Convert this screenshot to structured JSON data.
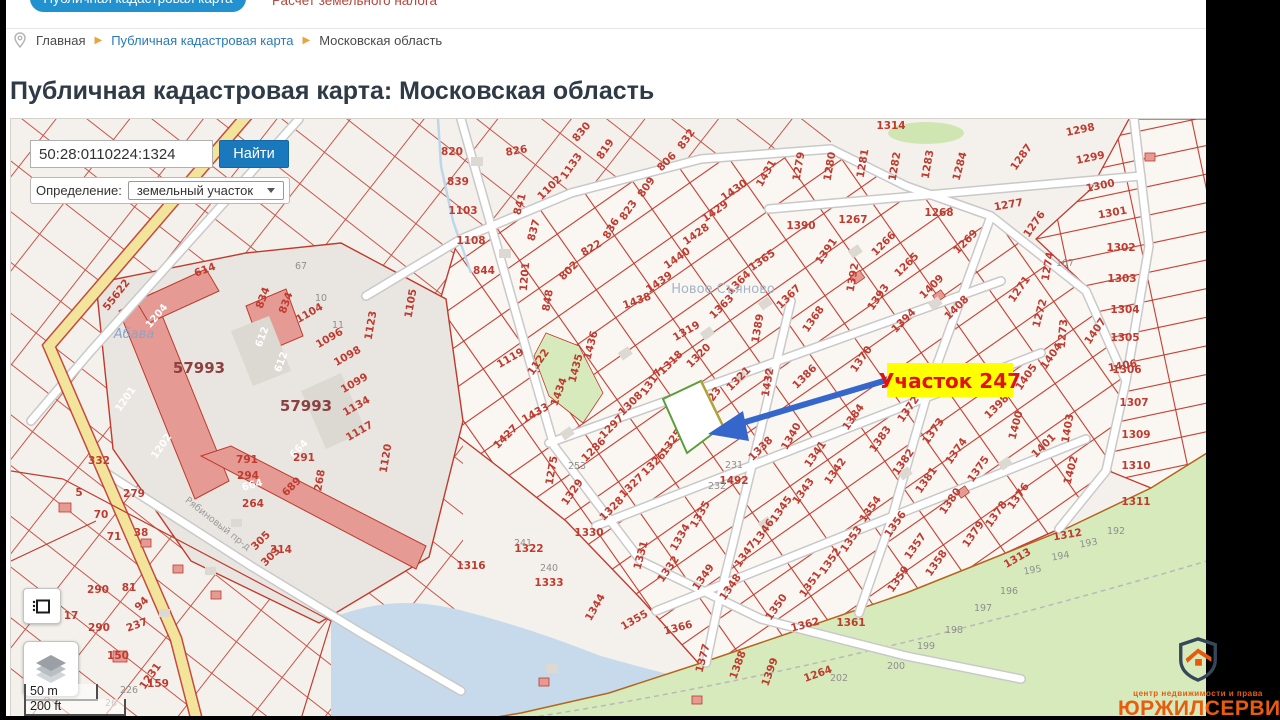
{
  "header": {
    "tab": "Публичная кадастровая карта",
    "link": "Расчет земельного налога"
  },
  "breadcrumb": {
    "items": [
      "Главная",
      "Публичная кадастровая карта",
      "Московская область"
    ]
  },
  "title": "Публичная кадастровая карта: Московская область",
  "search": {
    "value": "50:28:0110224:1324",
    "button": "Найти",
    "filter_label": "Определение:",
    "filter_value": "земельный участок"
  },
  "map": {
    "annotation": {
      "text": "Участок 247",
      "bg": "#ffff00",
      "color": "#e01212"
    },
    "scale": {
      "metric": "50 m",
      "imperial": "200 ft"
    },
    "labels": [
      [
        "55622",
        118,
        296,
        -52
      ],
      [
        "820",
        451,
        154,
        0
      ],
      [
        "839",
        457,
        184,
        0
      ],
      [
        "1103",
        462,
        213,
        0
      ],
      [
        "1108",
        470,
        243,
        0
      ],
      [
        "844",
        483,
        273,
        0
      ],
      [
        "826",
        516,
        153,
        -10
      ],
      [
        "841",
        522,
        204,
        -75
      ],
      [
        "837",
        536,
        230,
        -75
      ],
      [
        "1201",
        527,
        276,
        -85
      ],
      [
        "1133",
        573,
        167,
        -55
      ],
      [
        "1102",
        551,
        189,
        -45
      ],
      [
        "830",
        583,
        133,
        -50
      ],
      [
        "819",
        607,
        150,
        -55
      ],
      [
        "806",
        668,
        163,
        -45
      ],
      [
        "809",
        648,
        188,
        -55
      ],
      [
        "823",
        630,
        211,
        -55
      ],
      [
        "832",
        688,
        140,
        -55
      ],
      [
        "836",
        613,
        229,
        -60
      ],
      [
        "822",
        592,
        250,
        -30
      ],
      [
        "802",
        570,
        272,
        -45
      ],
      [
        "848",
        550,
        300,
        -80
      ],
      [
        "1431",
        768,
        174,
        -60
      ],
      [
        "1430",
        735,
        192,
        -35
      ],
      [
        "1429",
        716,
        213,
        -35
      ],
      [
        "1428",
        697,
        236,
        -35
      ],
      [
        "1440",
        678,
        260,
        -35
      ],
      [
        "1439",
        660,
        284,
        -35
      ],
      [
        "1438",
        637,
        303,
        -20
      ],
      [
        "1279",
        801,
        166,
        -80
      ],
      [
        "1280",
        832,
        166,
        -80
      ],
      [
        "1281",
        865,
        163,
        -80
      ],
      [
        "1282",
        897,
        166,
        -80
      ],
      [
        "1283",
        930,
        164,
        -80
      ],
      [
        "1284",
        962,
        166,
        -75
      ],
      [
        "1314",
        890,
        128,
        0
      ],
      [
        "1267",
        852,
        222,
        0
      ],
      [
        "1390",
        800,
        228,
        0
      ],
      [
        "1268",
        938,
        215,
        0
      ],
      [
        "1269",
        967,
        243,
        -45
      ],
      [
        "1266",
        885,
        245,
        -45
      ],
      [
        "1265",
        908,
        266,
        -45
      ],
      [
        "1409",
        933,
        288,
        -45
      ],
      [
        "1408",
        958,
        309,
        -45
      ],
      [
        "1391",
        828,
        252,
        -55
      ],
      [
        "1392",
        855,
        277,
        -80
      ],
      [
        "1393",
        880,
        298,
        -55
      ],
      [
        "1394",
        905,
        322,
        -45
      ],
      [
        "1365",
        763,
        262,
        -35
      ],
      [
        "1364",
        740,
        284,
        -45
      ],
      [
        "1363",
        723,
        308,
        -45
      ],
      [
        "1367",
        790,
        298,
        -45
      ],
      [
        "1368",
        815,
        320,
        -55
      ],
      [
        "1389",
        760,
        328,
        -80
      ],
      [
        "1319",
        687,
        333,
        -30
      ],
      [
        "1287",
        1023,
        158,
        -55
      ],
      [
        "1298",
        1080,
        132,
        -12
      ],
      [
        "1299",
        1090,
        160,
        -12
      ],
      [
        "1300",
        1100,
        188,
        -12
      ],
      [
        "1301",
        1112,
        215,
        -10
      ],
      [
        "1302",
        1120,
        250,
        0
      ],
      [
        "1303",
        1121,
        281,
        0
      ],
      [
        "1304",
        1124,
        312,
        0
      ],
      [
        "1305",
        1124,
        340,
        0
      ],
      [
        "1306",
        1126,
        372,
        0
      ],
      [
        "1277",
        1008,
        207,
        -10
      ],
      [
        "1276",
        1036,
        225,
        -55
      ],
      [
        "1274",
        1050,
        266,
        -80
      ],
      [
        "1271",
        1021,
        290,
        -55
      ],
      [
        "1272",
        1042,
        313,
        -75
      ],
      [
        "1273",
        1065,
        333,
        -85
      ],
      [
        "167",
        1064,
        265,
        0,
        "g"
      ],
      [
        "1307",
        1133,
        405,
        0
      ],
      [
        "1309",
        1135,
        437,
        0
      ],
      [
        "1310",
        1135,
        468,
        0
      ],
      [
        "1311",
        1135,
        504,
        0
      ],
      [
        "1312",
        1067,
        537,
        -10
      ],
      [
        "1313",
        1018,
        560,
        -30
      ],
      [
        "1403",
        1070,
        428,
        -80
      ],
      [
        "1400",
        1018,
        425,
        -75
      ],
      [
        "1401",
        1045,
        447,
        -45
      ],
      [
        "1402",
        1073,
        470,
        -75
      ],
      [
        "1398",
        998,
        408,
        -45
      ],
      [
        "1405",
        1028,
        378,
        -55
      ],
      [
        "1404",
        1053,
        357,
        -55
      ],
      [
        "1407",
        1097,
        332,
        -55
      ],
      [
        "1406",
        1122,
        368,
        -10
      ],
      [
        "1372",
        910,
        410,
        -55
      ],
      [
        "1373",
        935,
        432,
        -55
      ],
      [
        "1374",
        958,
        452,
        -55
      ],
      [
        "1375",
        980,
        470,
        -55
      ],
      [
        "1376",
        1020,
        497,
        -55
      ],
      [
        "1378",
        998,
        515,
        -55
      ],
      [
        "1379",
        975,
        535,
        -55
      ],
      [
        "1380",
        952,
        502,
        -55
      ],
      [
        "1381",
        928,
        481,
        -55
      ],
      [
        "1382",
        905,
        463,
        -55
      ],
      [
        "1383",
        882,
        440,
        -55
      ],
      [
        "1356",
        897,
        525,
        -55
      ],
      [
        "1357",
        917,
        547,
        -55
      ],
      [
        "1358",
        938,
        564,
        -55
      ],
      [
        "1359",
        900,
        580,
        -55
      ],
      [
        "1370",
        863,
        360,
        -55
      ],
      [
        "1384",
        855,
        418,
        -55
      ],
      [
        "1386",
        806,
        378,
        -45
      ],
      [
        "1432",
        770,
        382,
        -80
      ],
      [
        "1318",
        672,
        364,
        -45
      ],
      [
        "1317",
        653,
        383,
        -55
      ],
      [
        "1320",
        700,
        357,
        -45
      ],
      [
        "1321",
        740,
        380,
        -45
      ],
      [
        "1323",
        712,
        401,
        -55
      ],
      [
        "1119",
        511,
        360,
        -30
      ],
      [
        "1122",
        540,
        363,
        -55
      ],
      [
        "1436",
        593,
        345,
        -75
      ],
      [
        "1435",
        578,
        368,
        -75
      ],
      [
        "1434",
        561,
        392,
        -70
      ],
      [
        "1433",
        536,
        415,
        -30
      ],
      [
        "1427",
        507,
        438,
        -45
      ],
      [
        "1308",
        632,
        405,
        -45
      ],
      [
        "1297",
        613,
        428,
        -45
      ],
      [
        "1286",
        595,
        451,
        -45
      ],
      [
        "1275",
        554,
        470,
        -80
      ],
      [
        "1329",
        574,
        493,
        -55
      ],
      [
        "1325",
        673,
        443,
        -55
      ],
      [
        "1326",
        655,
        465,
        -45
      ],
      [
        "1327",
        633,
        487,
        -45
      ],
      [
        "1328",
        613,
        510,
        -45
      ],
      [
        "1330",
        588,
        535,
        0
      ],
      [
        "1331",
        643,
        555,
        -75
      ],
      [
        "1332",
        670,
        570,
        -55
      ],
      [
        "1334",
        682,
        538,
        -60
      ],
      [
        "1335",
        702,
        515,
        -60
      ],
      [
        "1333",
        548,
        585,
        0
      ],
      [
        "1344",
        597,
        608,
        -60
      ],
      [
        "1355",
        635,
        622,
        -30
      ],
      [
        "1366",
        678,
        630,
        -15
      ],
      [
        "1377",
        705,
        658,
        -75
      ],
      [
        "1388",
        740,
        665,
        -70
      ],
      [
        "1399",
        772,
        672,
        -70
      ],
      [
        "1264",
        818,
        676,
        -20
      ],
      [
        "1338",
        762,
        450,
        -45
      ],
      [
        "1492",
        733,
        483,
        0
      ],
      [
        "1340",
        793,
        437,
        -60
      ],
      [
        "1341",
        817,
        455,
        -55
      ],
      [
        "1342",
        837,
        472,
        -55
      ],
      [
        "1343",
        805,
        492,
        -55
      ],
      [
        "1345",
        783,
        510,
        -55
      ],
      [
        "1346",
        765,
        533,
        -55
      ],
      [
        "1347",
        747,
        555,
        -55
      ],
      [
        "1348",
        732,
        588,
        -55
      ],
      [
        "1349",
        705,
        578,
        -55
      ],
      [
        "1350",
        778,
        608,
        -55
      ],
      [
        "1351",
        812,
        585,
        -55
      ],
      [
        "1352",
        832,
        562,
        -55
      ],
      [
        "1353",
        853,
        540,
        -55
      ],
      [
        "1354",
        872,
        510,
        -55
      ],
      [
        "1362",
        805,
        627,
        -15
      ],
      [
        "1361",
        850,
        625,
        0
      ],
      [
        "1322",
        528,
        551,
        0
      ],
      [
        "1316",
        470,
        568,
        0
      ],
      [
        "231",
        733,
        467,
        0,
        "g"
      ],
      [
        "232",
        716,
        488,
        0,
        "g"
      ],
      [
        "240",
        548,
        570,
        0,
        "g"
      ],
      [
        "241",
        522,
        545,
        0,
        "g"
      ],
      [
        "253",
        576,
        468,
        0,
        "g"
      ],
      [
        "192",
        1115,
        533,
        0,
        "g"
      ],
      [
        "193",
        1088,
        545,
        -10,
        "g"
      ],
      [
        "194",
        1060,
        558,
        -10,
        "g"
      ],
      [
        "195",
        1032,
        572,
        -10,
        "g"
      ],
      [
        "196",
        1008,
        593,
        0,
        "g"
      ],
      [
        "197",
        982,
        610,
        0,
        "g"
      ],
      [
        "198",
        953,
        632,
        0,
        "g"
      ],
      [
        "199",
        925,
        648,
        0,
        "g"
      ],
      [
        "200",
        895,
        668,
        0,
        "g"
      ],
      [
        "202",
        838,
        680,
        0,
        "g"
      ],
      [
        "10",
        320,
        300,
        0,
        "g"
      ],
      [
        "11",
        337,
        327,
        0,
        "g"
      ],
      [
        "67",
        300,
        268,
        0,
        "g"
      ],
      [
        "26",
        110,
        705,
        0,
        "g"
      ],
      [
        "226",
        128,
        692,
        0,
        "g"
      ],
      [
        "1204",
        158,
        317,
        -50,
        "w"
      ],
      [
        "612",
        264,
        337,
        -70,
        "w"
      ],
      [
        "612",
        283,
        362,
        -70,
        "w"
      ],
      [
        "614",
        205,
        272,
        -20
      ],
      [
        "834",
        265,
        298,
        -70
      ],
      [
        "834",
        288,
        303,
        -70
      ],
      [
        "1104",
        310,
        315,
        -30
      ],
      [
        "1096",
        330,
        340,
        -30
      ],
      [
        "1098",
        348,
        358,
        -30
      ],
      [
        "1099",
        355,
        385,
        -30
      ],
      [
        "1123",
        373,
        325,
        -80
      ],
      [
        "1134",
        357,
        408,
        -30
      ],
      [
        "1117",
        360,
        433,
        -30
      ],
      [
        "1120",
        388,
        458,
        -80
      ],
      [
        "1105",
        413,
        303,
        -80
      ],
      [
        "57993",
        198,
        372,
        0,
        "b"
      ],
      [
        "57993",
        305,
        410,
        0,
        "b"
      ],
      [
        "1201",
        127,
        400,
        -55,
        "w"
      ],
      [
        "1202",
        163,
        447,
        -55,
        "w"
      ],
      [
        "664",
        300,
        450,
        -45,
        "w"
      ],
      [
        "664",
        252,
        487,
        -15,
        "w"
      ],
      [
        "5",
        78,
        495,
        0
      ],
      [
        "332",
        98,
        463,
        0
      ],
      [
        "279",
        133,
        496,
        0
      ],
      [
        "70",
        100,
        517,
        0
      ],
      [
        "71",
        113,
        539,
        0
      ],
      [
        "38",
        140,
        535,
        0
      ],
      [
        "305",
        262,
        542,
        -45
      ],
      [
        "303",
        272,
        558,
        -45
      ],
      [
        "314",
        280,
        552,
        0
      ],
      [
        "290",
        97,
        592,
        0
      ],
      [
        "81",
        128,
        590,
        0
      ],
      [
        "94",
        143,
        605,
        -45
      ],
      [
        "689",
        293,
        488,
        -45
      ],
      [
        "791",
        246,
        462,
        0
      ],
      [
        "294",
        247,
        478,
        0
      ],
      [
        "264",
        252,
        506,
        0
      ],
      [
        "268",
        322,
        480,
        -80
      ],
      [
        "291",
        303,
        460,
        0
      ],
      [
        "290",
        98,
        630,
        0
      ],
      [
        "17",
        70,
        618,
        0
      ],
      [
        "237",
        137,
        627,
        -20
      ],
      [
        "237",
        63,
        680,
        0
      ],
      [
        "1231",
        152,
        677,
        -55
      ],
      [
        "150",
        117,
        658,
        0
      ],
      [
        "159",
        157,
        686,
        0
      ],
      [
        "Новое Съяново",
        722,
        292,
        0,
        "p"
      ],
      [
        "Абава",
        133,
        337,
        0,
        "wt"
      ],
      [
        "Рябиновый пр-д",
        215,
        525,
        38,
        "rd"
      ]
    ]
  },
  "logo": {
    "tagline": "центр недвижимости и права",
    "name": "ЮРЖИЛСЕРВИС",
    "color": "#e85c0c"
  },
  "colors": {
    "parcel_line": "#bf3b2f",
    "water": "#c7daec",
    "forest": "#d6eabc",
    "road_yellow": "#f3e49b",
    "button_blue": "#1a78bd",
    "selected_outline": "#5a9e3a",
    "arrow": "#3566cc",
    "tab_blue": "#2191d0"
  }
}
